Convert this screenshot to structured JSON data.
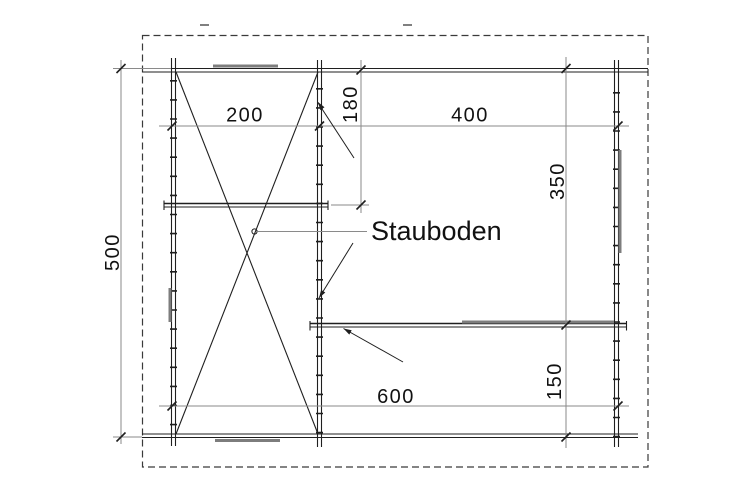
{
  "drawing": {
    "type": "floor-plan",
    "annotation_label": "Stauboden",
    "dimensions": {
      "room_left_width": "200",
      "loft_depth": "180",
      "room_right_width": "400",
      "room_right_height": "350",
      "overall_depth": "500",
      "overall_width": "600",
      "shelf_offset": "150"
    },
    "colors": {
      "line": "#1f1f1f",
      "dimension_line": "#8a8a8a",
      "fixture": "#7d7d7d",
      "boundary_dash": "#3a3a3a",
      "background": "#ffffff"
    }
  }
}
